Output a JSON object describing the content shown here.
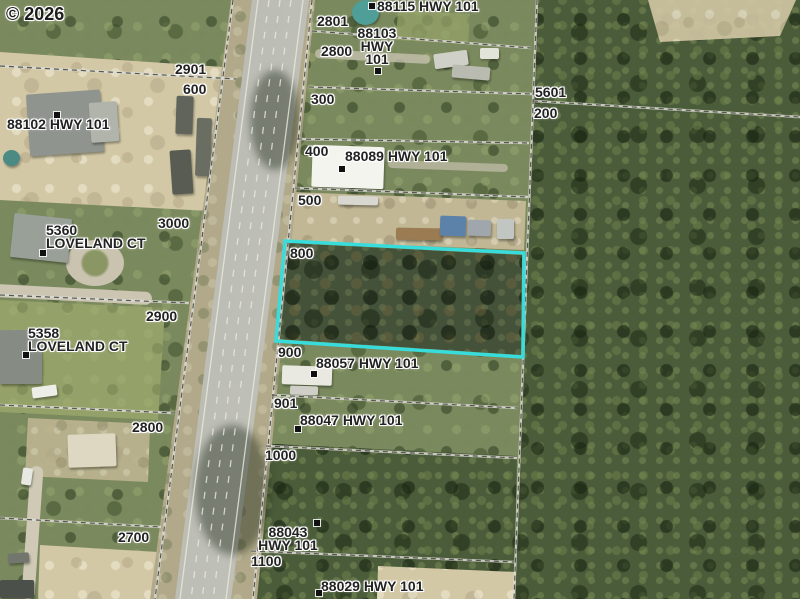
{
  "map": {
    "watermark": "© 2026",
    "width": 800,
    "height": 599,
    "palette": {
      "highlight_cyan": "#38dcdb",
      "forest_dark": "#4a5c39",
      "scrub_green": "#7b8a5e",
      "sand": "#d3c8a6",
      "road_gray": "#b6b7af",
      "label_text": "#222222",
      "label_halo": "#ffffff",
      "marker_black": "#111111",
      "water_teal": "#4f9e97"
    },
    "highlight_parcel": {
      "color": "#38dcdb",
      "stroke_width": 3.5,
      "points": [
        [
          285,
          241
        ],
        [
          524,
          253
        ],
        [
          523,
          357
        ],
        [
          276,
          341
        ]
      ]
    },
    "boundary_lines": [
      [
        233,
        0,
        155,
        599
      ],
      [
        312,
        0,
        253,
        599
      ],
      [
        312,
        31,
        531,
        48
      ],
      [
        309,
        87,
        532,
        94
      ],
      [
        297,
        139,
        529,
        143
      ],
      [
        295,
        188,
        528,
        197
      ],
      [
        272,
        395,
        517,
        408
      ],
      [
        266,
        446,
        517,
        458
      ],
      [
        251,
        551,
        514,
        562
      ],
      [
        0,
        66,
        236,
        79
      ],
      [
        0,
        295,
        189,
        303
      ],
      [
        0,
        405,
        174,
        413
      ],
      [
        0,
        518,
        161,
        527
      ],
      [
        533,
        101,
        800,
        117
      ],
      [
        537,
        0,
        514,
        599
      ]
    ],
    "road": {
      "lane_lines": [
        {
          "x1": 258,
          "y1": 0,
          "x2": 180,
          "y2": 599,
          "dash": false
        },
        {
          "x1": 303,
          "y1": 0,
          "x2": 226,
          "y2": 599,
          "dash": false
        },
        {
          "x1": 269,
          "y1": 0,
          "x2": 191,
          "y2": 599,
          "dash": true
        },
        {
          "x1": 280,
          "y1": 0,
          "x2": 202,
          "y2": 599,
          "dash": true
        },
        {
          "x1": 291,
          "y1": 0,
          "x2": 213,
          "y2": 599,
          "dash": true
        }
      ]
    },
    "labels": [
      {
        "id": "88115",
        "kind": "address",
        "text": "88115 HWY 101",
        "x": 377,
        "y": 0,
        "marker": [
          369,
          3
        ]
      },
      {
        "id": "2801",
        "kind": "lot",
        "text": "2801",
        "x": 317,
        "y": 15
      },
      {
        "id": "88103",
        "kind": "address",
        "text": "88103\nHWY\n101",
        "x": 345,
        "y": 27,
        "align": "center",
        "marker": [
          375,
          68
        ]
      },
      {
        "id": "2800-n",
        "kind": "lot",
        "text": "2800",
        "x": 321,
        "y": 45
      },
      {
        "id": "2901",
        "kind": "lot",
        "text": "2901",
        "x": 175,
        "y": 63
      },
      {
        "id": "600",
        "kind": "lot",
        "text": "600",
        "x": 183,
        "y": 83
      },
      {
        "id": "88102",
        "kind": "address",
        "text": "88102 HWY 101",
        "x": 7,
        "y": 118,
        "marker": [
          54,
          112
        ]
      },
      {
        "id": "300",
        "kind": "lot",
        "text": "300",
        "x": 311,
        "y": 93
      },
      {
        "id": "5601",
        "kind": "lot",
        "text": "5601",
        "x": 535,
        "y": 86
      },
      {
        "id": "200",
        "kind": "lot",
        "text": "200",
        "x": 534,
        "y": 107
      },
      {
        "id": "400",
        "kind": "lot",
        "text": "400",
        "x": 305,
        "y": 145
      },
      {
        "id": "88089",
        "kind": "address",
        "text": "88089 HWY 101",
        "x": 345,
        "y": 150,
        "marker": [
          339,
          166
        ]
      },
      {
        "id": "500",
        "kind": "lot",
        "text": "500",
        "x": 298,
        "y": 194
      },
      {
        "id": "3000",
        "kind": "lot",
        "text": "3000",
        "x": 158,
        "y": 217
      },
      {
        "id": "5360",
        "kind": "address",
        "text": "5360\nLOVELAND CT",
        "x": 46,
        "y": 224,
        "marker": [
          40,
          250
        ]
      },
      {
        "id": "800",
        "kind": "lot",
        "text": "800",
        "x": 290,
        "y": 247
      },
      {
        "id": "2900",
        "kind": "lot",
        "text": "2900",
        "x": 146,
        "y": 310
      },
      {
        "id": "5358",
        "kind": "address",
        "text": "5358\nLOVELAND CT",
        "x": 28,
        "y": 327,
        "marker": [
          23,
          352
        ]
      },
      {
        "id": "900",
        "kind": "lot",
        "text": "900",
        "x": 278,
        "y": 346
      },
      {
        "id": "88057",
        "kind": "address",
        "text": "88057 HWY 101",
        "x": 316,
        "y": 357,
        "marker": [
          311,
          371
        ]
      },
      {
        "id": "901",
        "kind": "lot",
        "text": "901",
        "x": 274,
        "y": 397
      },
      {
        "id": "88047",
        "kind": "address",
        "text": "88047 HWY 101",
        "x": 300,
        "y": 414,
        "marker": [
          295,
          426
        ]
      },
      {
        "id": "2800-s",
        "kind": "lot",
        "text": "2800",
        "x": 132,
        "y": 421
      },
      {
        "id": "1000",
        "kind": "lot",
        "text": "1000",
        "x": 265,
        "y": 449
      },
      {
        "id": "2700",
        "kind": "lot",
        "text": "2700",
        "x": 118,
        "y": 531
      },
      {
        "id": "88043",
        "kind": "address",
        "text": "88043\nHWY 101",
        "x": 256,
        "y": 526,
        "align": "center",
        "marker": [
          314,
          520
        ]
      },
      {
        "id": "1100",
        "kind": "lot",
        "text": "1100",
        "x": 251,
        "y": 555
      },
      {
        "id": "88029",
        "kind": "address",
        "text": "88029 HWY 101",
        "x": 321,
        "y": 580,
        "marker": [
          316,
          590
        ]
      }
    ],
    "structures": [
      {
        "id": "house-88102",
        "x": 28,
        "y": 92,
        "w": 74,
        "h": 62,
        "color": "#8f948e",
        "rot": -4
      },
      {
        "id": "house-88102-wing",
        "x": 90,
        "y": 102,
        "w": 28,
        "h": 40,
        "color": "#b0b4aa",
        "rot": -4
      },
      {
        "id": "trailer-nw-a",
        "x": 176,
        "y": 96,
        "w": 17,
        "h": 38,
        "color": "#60645a",
        "rot": 2
      },
      {
        "id": "trailer-nw-b",
        "x": 196,
        "y": 118,
        "w": 15,
        "h": 58,
        "color": "#6a6e62",
        "rot": 2
      },
      {
        "id": "trailer-nw-c",
        "x": 171,
        "y": 150,
        "w": 21,
        "h": 44,
        "color": "#585c52",
        "rot": -4
      },
      {
        "id": "house-5360",
        "x": 12,
        "y": 216,
        "w": 58,
        "h": 44,
        "color": "#99a098",
        "rot": 6
      },
      {
        "id": "house-5358",
        "x": 0,
        "y": 330,
        "w": 42,
        "h": 54,
        "color": "#868b84",
        "rot": 0
      },
      {
        "id": "house-88089",
        "x": 312,
        "y": 146,
        "w": 72,
        "h": 42,
        "color": "#f4f4ef",
        "rot": 2
      },
      {
        "id": "shed-88089",
        "x": 338,
        "y": 196,
        "w": 40,
        "h": 9,
        "color": "#d8d8d1",
        "rot": 1
      },
      {
        "id": "truck-500",
        "x": 396,
        "y": 228,
        "w": 46,
        "h": 12,
        "color": "#9a7b52",
        "rot": 1
      },
      {
        "id": "rv-blue",
        "x": 440,
        "y": 216,
        "w": 26,
        "h": 20,
        "color": "#5d82aa",
        "rot": 2
      },
      {
        "id": "rv-gray",
        "x": 468,
        "y": 220,
        "w": 23,
        "h": 16,
        "color": "#9fa7ad",
        "rot": 2
      },
      {
        "id": "trailer-500",
        "x": 497,
        "y": 219,
        "w": 17,
        "h": 20,
        "color": "#c2c6c2",
        "rot": 0
      },
      {
        "id": "house-88057",
        "x": 282,
        "y": 366,
        "w": 50,
        "h": 19,
        "color": "#e9e9e1",
        "rot": 2
      },
      {
        "id": "shed-88057",
        "x": 290,
        "y": 386,
        "w": 28,
        "h": 9,
        "color": "#cfcfc7",
        "rot": 2
      },
      {
        "id": "clutter-88103-a",
        "x": 434,
        "y": 52,
        "w": 34,
        "h": 15,
        "color": "#cfd0c7",
        "rot": -8
      },
      {
        "id": "clutter-88103-b",
        "x": 452,
        "y": 66,
        "w": 38,
        "h": 13,
        "color": "#b9bbb1",
        "rot": 5
      },
      {
        "id": "clutter-88103-c",
        "x": 480,
        "y": 48,
        "w": 19,
        "h": 11,
        "color": "#e2e3d9",
        "rot": 0
      },
      {
        "id": "building-sw",
        "x": 68,
        "y": 434,
        "w": 48,
        "h": 33,
        "color": "#ded7c2",
        "rot": -2
      },
      {
        "id": "shed-s",
        "x": 0,
        "y": 580,
        "w": 34,
        "h": 18,
        "color": "#4c504a",
        "rot": 0
      },
      {
        "id": "car-w",
        "x": 22,
        "y": 468,
        "w": 10,
        "h": 17,
        "color": "#e8e8e3",
        "rot": 8
      },
      {
        "id": "car-sw",
        "x": 8,
        "y": 553,
        "w": 21,
        "h": 10,
        "color": "#72766e",
        "rot": -4
      },
      {
        "id": "rv-west",
        "x": 32,
        "y": 386,
        "w": 25,
        "h": 11,
        "color": "#eceee7",
        "rot": -8
      },
      {
        "id": "pool-88115",
        "x": 352,
        "y": 0,
        "w": 27,
        "h": 25,
        "color": "#4f9e97",
        "rot": 0,
        "round": true
      },
      {
        "id": "pond-west",
        "x": 3,
        "y": 150,
        "w": 17,
        "h": 16,
        "color": "#4c8a84",
        "rot": 0,
        "round": true
      }
    ]
  }
}
